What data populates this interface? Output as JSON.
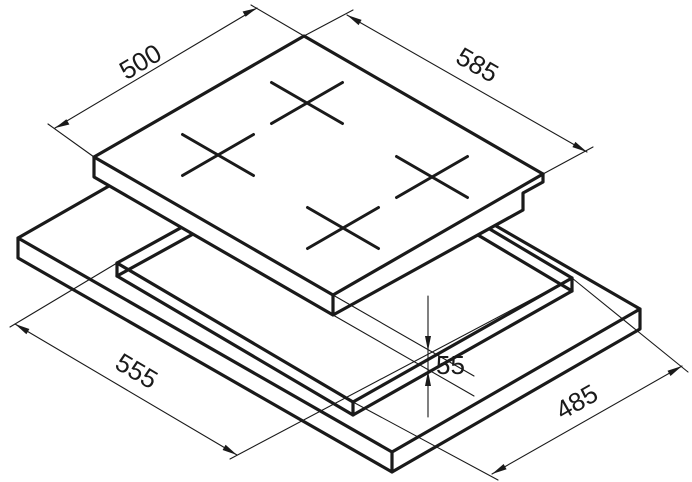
{
  "drawing": {
    "type": "isometric installation diagram",
    "subject": "built-in hob over worktop cutout",
    "background_color": "#ffffff",
    "line_color": "#1a1a1a",
    "burner_count": 4,
    "dimensions": {
      "hob_depth": "500",
      "hob_width": "585",
      "cutout_depth": "555",
      "cutout_width": "485",
      "install_height": "55"
    }
  }
}
